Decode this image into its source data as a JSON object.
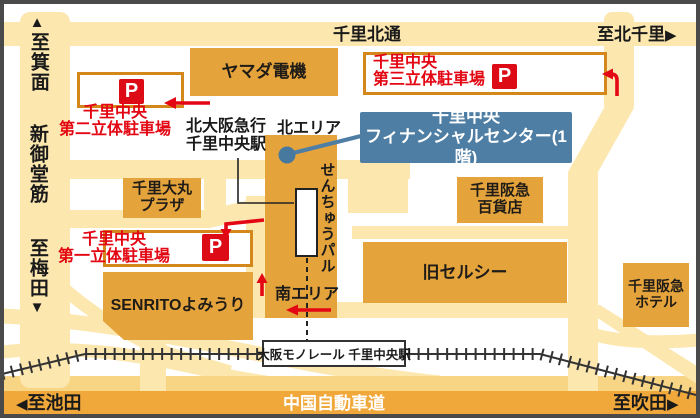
{
  "roads": {
    "top_label": "千里北通",
    "left_label": "新御堂筋",
    "highway_label": "中国自動車道"
  },
  "directions": {
    "minoo": "至箕面",
    "kita_senri": "至北千里",
    "umeda": "至梅田",
    "ikeda": "至池田",
    "suita": "至吹田",
    "up_triangle": "▲",
    "down_triangle": "▼",
    "left_triangle": "◀",
    "right_triangle": "▶"
  },
  "buildings": {
    "yamada": "ヤマダ電機",
    "daimaru_l1": "千里大丸",
    "daimaru_l2": "プラザ",
    "senrito": "SENRITOよみうり",
    "dept_l1": "千里阪急",
    "dept_l2": "百貨店",
    "celcy": "旧セルシー",
    "hotel_l1": "千里阪急",
    "hotel_l2": "ホテル"
  },
  "parking": {
    "p_mark": "P",
    "second_l1": "千里中央",
    "second_l2": "第二立体駐車場",
    "third_l1": "千里中央",
    "third_l2": "第三立体駐車場",
    "first_l1": "千里中央",
    "first_l2": "第一立体駐車場"
  },
  "station": {
    "kita_osaka_l1": "北大阪急行",
    "kita_osaka_l2": "千里中央駅",
    "north_area": "北エリア",
    "south_area": "南エリア",
    "senchu_pal": "せんちゅうパル",
    "monorail_station": "大阪モノレール 千里中央駅"
  },
  "finance_center": {
    "l1": "千里中央",
    "l2": "フィナンシャルセンター(1階)"
  },
  "colors": {
    "road": "#fce7af",
    "building": "#e5a33c",
    "highway_band": "#f1a83b",
    "parking_border": "#d4881c",
    "red_accent": "#e30613",
    "finance_blue": "#4e7ea4"
  }
}
